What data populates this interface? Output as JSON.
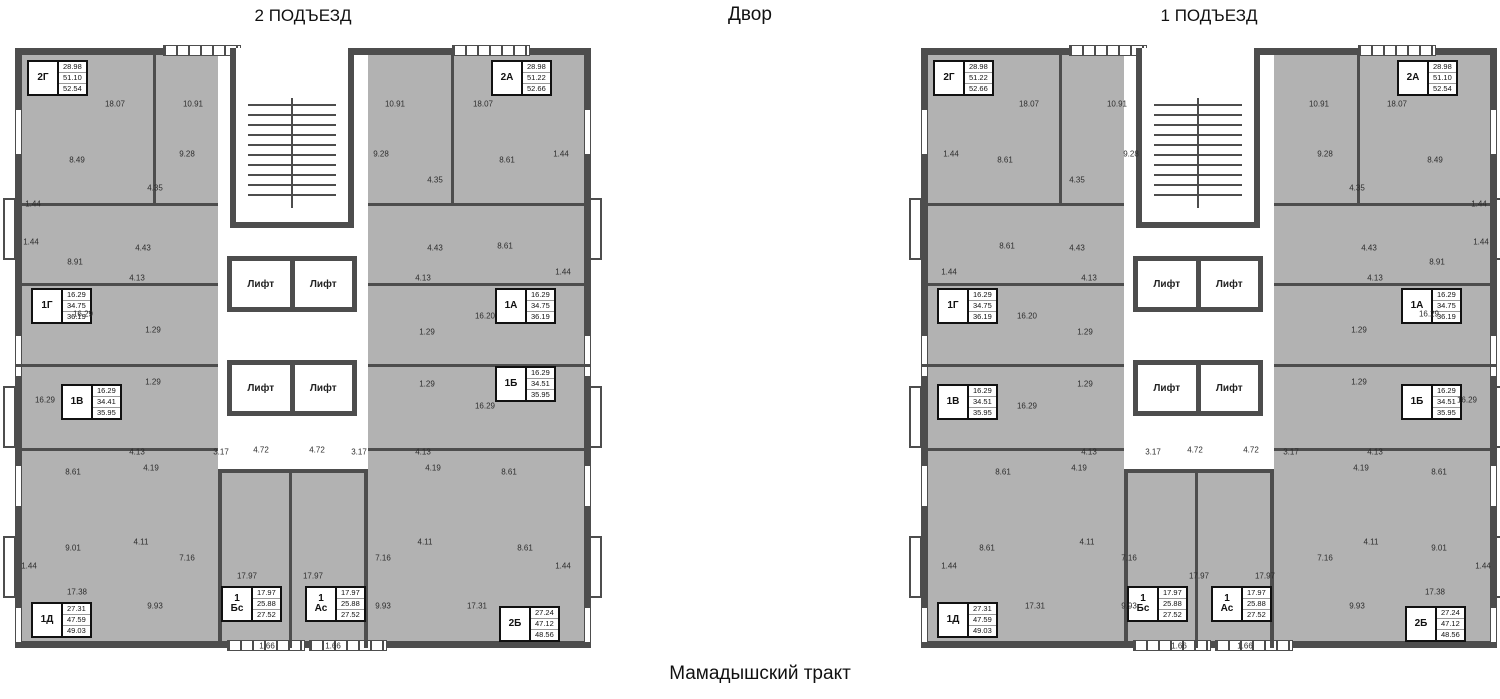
{
  "titles": {
    "entrance2": "2 ПОДЪЕЗД",
    "courtyard": "Двор",
    "entrance1": "1 ПОДЪЕЗД",
    "street": "Мамадышский тракт"
  },
  "lift_label": "Лифт",
  "colors": {
    "wall": "#4d4d4d",
    "fill": "#b2b2b2",
    "paper": "#ffffff"
  },
  "buildings": [
    {
      "name": "building-entrance-2",
      "title": "2 ПОДЪЕЗД",
      "mirrored": false,
      "apartments": [
        {
          "label": "2Г",
          "areas": [
            "28.98",
            "51.10",
            "52.54"
          ],
          "x": 12,
          "y": 12
        },
        {
          "label": "2А",
          "areas": [
            "28.98",
            "51.22",
            "52.66"
          ],
          "x": 476,
          "y": 12
        },
        {
          "label": "1Г",
          "areas": [
            "16.29",
            "34.75",
            "36.19"
          ],
          "x": 16,
          "y": 240
        },
        {
          "label": "1А",
          "areas": [
            "16.29",
            "34.75",
            "36.19"
          ],
          "x": 480,
          "y": 240
        },
        {
          "label": "1В",
          "areas": [
            "16.29",
            "34.41",
            "35.95"
          ],
          "x": 46,
          "y": 336
        },
        {
          "label": "1Б",
          "areas": [
            "16.29",
            "34.51",
            "35.95"
          ],
          "x": 480,
          "y": 318
        },
        {
          "label": "1Д",
          "areas": [
            "27.31",
            "47.59",
            "49.03"
          ],
          "x": 16,
          "y": 554
        },
        {
          "label": "1",
          "label2": "Бс",
          "areas": [
            "17.97",
            "25.88",
            "27.52"
          ],
          "x": 206,
          "y": 538
        },
        {
          "label": "1",
          "label2": "Ас",
          "areas": [
            "17.97",
            "25.88",
            "27.52"
          ],
          "x": 290,
          "y": 538
        },
        {
          "label": "2Б",
          "areas": [
            "27.24",
            "47.12",
            "48.56"
          ],
          "x": 484,
          "y": 558
        }
      ]
    },
    {
      "name": "building-entrance-1",
      "title": "1 ПОДЪЕЗД",
      "mirrored": true,
      "apartments": [
        {
          "label": "2Г",
          "areas": [
            "28.98",
            "51.22",
            "52.66"
          ],
          "x": 12,
          "y": 12
        },
        {
          "label": "2А",
          "areas": [
            "28.98",
            "51.10",
            "52.54"
          ],
          "x": 476,
          "y": 12
        },
        {
          "label": "1Г",
          "areas": [
            "16.29",
            "34.75",
            "36.19"
          ],
          "x": 16,
          "y": 240
        },
        {
          "label": "1А",
          "areas": [
            "16.29",
            "34.75",
            "36.19"
          ],
          "x": 480,
          "y": 240
        },
        {
          "label": "1В",
          "areas": [
            "16.29",
            "34.51",
            "35.95"
          ],
          "x": 16,
          "y": 336
        },
        {
          "label": "1Б",
          "areas": [
            "16.29",
            "34.51",
            "35.95"
          ],
          "x": 480,
          "y": 336
        },
        {
          "label": "1Д",
          "areas": [
            "27.31",
            "47.59",
            "49.03"
          ],
          "x": 16,
          "y": 554
        },
        {
          "label": "1",
          "label2": "Бс",
          "areas": [
            "17.97",
            "25.88",
            "27.52"
          ],
          "x": 206,
          "y": 538
        },
        {
          "label": "1",
          "label2": "Ас",
          "areas": [
            "17.97",
            "25.88",
            "27.52"
          ],
          "x": 290,
          "y": 538
        },
        {
          "label": "2Б",
          "areas": [
            "27.24",
            "47.12",
            "48.56"
          ],
          "x": 484,
          "y": 558
        }
      ]
    }
  ],
  "plan_labels": [
    {
      "t": "18.07",
      "x": 100,
      "y": 56
    },
    {
      "t": "10.91",
      "x": 178,
      "y": 56
    },
    {
      "t": "10.91",
      "x": 380,
      "y": 56
    },
    {
      "t": "18.07",
      "x": 468,
      "y": 56
    },
    {
      "t": "9.28",
      "x": 172,
      "y": 106
    },
    {
      "t": "9.28",
      "x": 366,
      "y": 106
    },
    {
      "t": "8.49",
      "x": 62,
      "y": 112
    },
    {
      "t": "8.61",
      "x": 492,
      "y": 112
    },
    {
      "t": "1.44",
      "x": 546,
      "y": 106
    },
    {
      "t": "4.35",
      "x": 140,
      "y": 140
    },
    {
      "t": "4.35",
      "x": 420,
      "y": 132
    },
    {
      "t": "1.44",
      "x": 18,
      "y": 156
    },
    {
      "t": "8.91",
      "x": 60,
      "y": 214
    },
    {
      "t": "8.61",
      "x": 490,
      "y": 198
    },
    {
      "t": "4.43",
      "x": 128,
      "y": 200
    },
    {
      "t": "4.43",
      "x": 420,
      "y": 200
    },
    {
      "t": "1.44",
      "x": 16,
      "y": 194
    },
    {
      "t": "1.44",
      "x": 548,
      "y": 224
    },
    {
      "t": "4.13",
      "x": 122,
      "y": 230
    },
    {
      "t": "4.13",
      "x": 408,
      "y": 230
    },
    {
      "t": "16.29",
      "x": 68,
      "y": 266
    },
    {
      "t": "1.29",
      "x": 138,
      "y": 282
    },
    {
      "t": "1.29",
      "x": 412,
      "y": 284
    },
    {
      "t": "16.20",
      "x": 470,
      "y": 268
    },
    {
      "t": "1.29",
      "x": 138,
      "y": 334
    },
    {
      "t": "1.29",
      "x": 412,
      "y": 336
    },
    {
      "t": "16.29",
      "x": 30,
      "y": 352
    },
    {
      "t": "16.29",
      "x": 470,
      "y": 358
    },
    {
      "t": "4.13",
      "x": 122,
      "y": 404
    },
    {
      "t": "4.13",
      "x": 408,
      "y": 404
    },
    {
      "t": "4.19",
      "x": 136,
      "y": 420
    },
    {
      "t": "4.19",
      "x": 418,
      "y": 420
    },
    {
      "t": "8.61",
      "x": 58,
      "y": 424
    },
    {
      "t": "8.61",
      "x": 494,
      "y": 424
    },
    {
      "t": "3.17",
      "x": 206,
      "y": 404
    },
    {
      "t": "3.17",
      "x": 344,
      "y": 404
    },
    {
      "t": "4.72",
      "x": 246,
      "y": 402
    },
    {
      "t": "4.72",
      "x": 302,
      "y": 402
    },
    {
      "t": "9.01",
      "x": 58,
      "y": 500
    },
    {
      "t": "8.61",
      "x": 510,
      "y": 500
    },
    {
      "t": "4.11",
      "x": 126,
      "y": 494
    },
    {
      "t": "4.11",
      "x": 410,
      "y": 494
    },
    {
      "t": "7.16",
      "x": 172,
      "y": 510
    },
    {
      "t": "7.16",
      "x": 368,
      "y": 510
    },
    {
      "t": "1.44",
      "x": 14,
      "y": 518
    },
    {
      "t": "1.44",
      "x": 548,
      "y": 518
    },
    {
      "t": "17.97",
      "x": 232,
      "y": 528
    },
    {
      "t": "17.97",
      "x": 298,
      "y": 528
    },
    {
      "t": "17.38",
      "x": 62,
      "y": 544
    },
    {
      "t": "9.93",
      "x": 140,
      "y": 558
    },
    {
      "t": "9.93",
      "x": 368,
      "y": 558
    },
    {
      "t": "17.31",
      "x": 462,
      "y": 558
    },
    {
      "t": "1.66",
      "x": 252,
      "y": 598
    },
    {
      "t": "1.66",
      "x": 318,
      "y": 598
    }
  ]
}
